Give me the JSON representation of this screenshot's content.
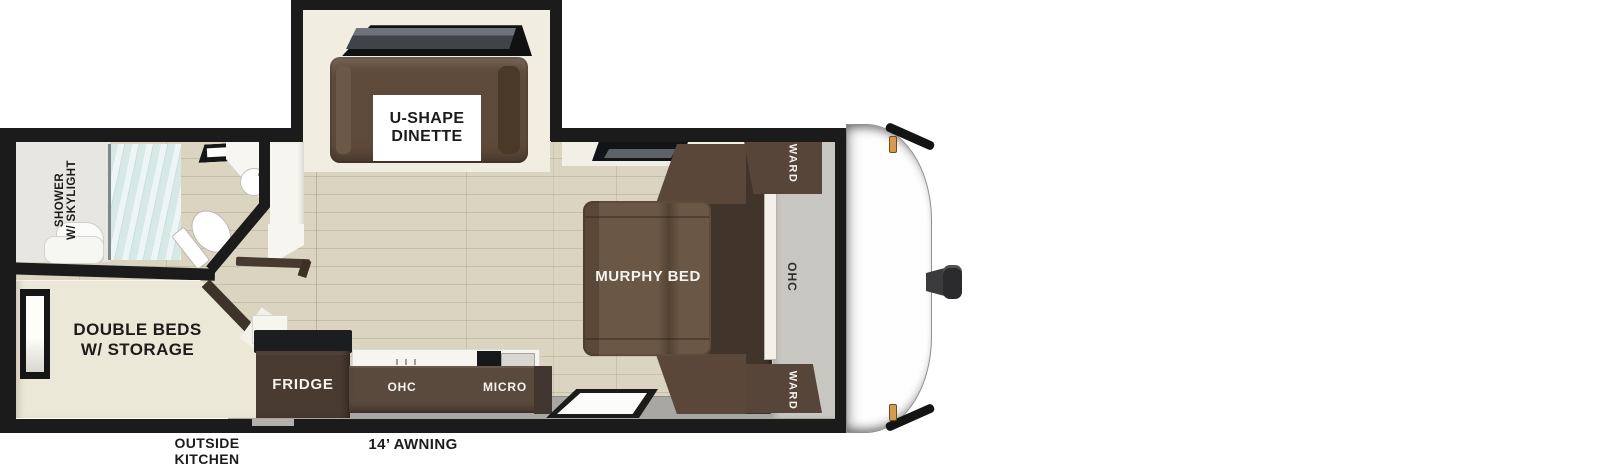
{
  "title": "Travel trailer floor plan",
  "colors": {
    "c-wall": "#1b1b1c",
    "c-cream": "#ece8d8",
    "c-bench": "#5e4a3a",
    "c-mattress": "#6b5746",
    "c-sofa": "#41342b",
    "c-ward": "#57453a",
    "c-cabinet": "#5a4a3e",
    "c-fridge": "#4a3b31",
    "c-gray-panel": "#c9c7c1",
    "c-walkway": "#a8a7a3",
    "c-glass": "#d7e9e7",
    "c-marker": "#d79a4f"
  },
  "rooms": {
    "dinette": {
      "line1": "U-SHAPE",
      "line2": "DINETTE"
    },
    "shower": {
      "line1": "SHOWER",
      "line2": "W/ SKYLIGHT"
    },
    "double_beds": {
      "line1": "DOUBLE BEDS",
      "line2": "W/ STORAGE"
    },
    "murphy_bed": {
      "label": "MURPHY BED"
    },
    "kitchen": {
      "fridge": "FRIDGE",
      "ohc": "OHC",
      "micro": "MICRO"
    },
    "front": {
      "ward_top": "WARD",
      "ohc": "OHC",
      "ward_bottom": "WARD"
    }
  },
  "exterior": {
    "outside_kitchen_line1": "OUTSIDE",
    "outside_kitchen_line2": "KITCHEN",
    "awning": "14’ AWNING"
  }
}
